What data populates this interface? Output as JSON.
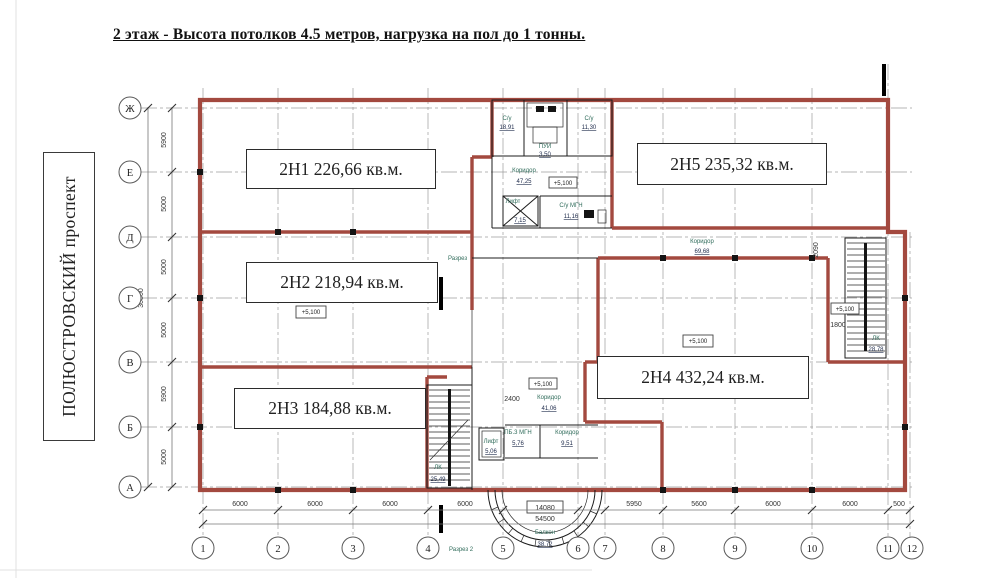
{
  "title": "2 этаж - Высота потолков 4.5 метров, нагрузка на пол до 1 тонны.",
  "street": "ПОЛЮСТРОВСКИЙ проспект",
  "units": {
    "u1": "2Н1 226,66 кв.м.",
    "u2": "2Н2 218,94 кв.м.",
    "u3": "2Н3 184,88 кв.м.",
    "u4": "2Н4 432,24 кв.м.",
    "u5": "2Н5 235,32 кв.м."
  },
  "axes": {
    "rows": [
      "Ж",
      "Е",
      "Д",
      "Г",
      "В",
      "Б",
      "А"
    ],
    "cols": [
      "1",
      "2",
      "3",
      "4",
      "5",
      "6",
      "7",
      "8",
      "9",
      "10",
      "11",
      "12"
    ],
    "row_dims": [
      "5900",
      "5000",
      "5000",
      "5000",
      "5900",
      "5000"
    ],
    "row_total": "30800",
    "col_dims": [
      "6000",
      "6000",
      "6000",
      "6000",
      "5950",
      "5600",
      "6000",
      "6000",
      "500"
    ],
    "col_total": "54500"
  },
  "rooms": {
    "su_left": {
      "name": "С/у",
      "area": "18,91"
    },
    "su_right": {
      "name": "С/у",
      "area": "11,30"
    },
    "pui": {
      "name": "ПУИ",
      "area": "3,50"
    },
    "corridor_top": {
      "name": "Коридор",
      "area": "47,25"
    },
    "lift_top": {
      "name": "Лифт",
      "area": "7,15"
    },
    "su_mgn": {
      "name": "С/у МГН",
      "area": "11,16"
    },
    "corridor_mid": {
      "name": "Коридор",
      "area": "69,68"
    },
    "lk_right": {
      "name": "ЛК",
      "area": "28,78"
    },
    "corridor_low": {
      "name": "Коридор",
      "area": "41,06"
    },
    "pb_mgn": {
      "name": "ПБ.3 МГН",
      "area": "5,76"
    },
    "corridor_small": {
      "name": "Коридор",
      "area": "9,51"
    },
    "lift_low": {
      "name": "Лифт",
      "area": "5,06"
    },
    "lk_low": {
      "name": "ЛК",
      "area": "25,49"
    },
    "balcony": {
      "name": "Балкон",
      "area": "38,72"
    }
  },
  "marks": {
    "elevation": "+5,100",
    "section1": "Разрез",
    "section2": "Разрез 2",
    "dim_1800": "1800",
    "dim_2090": "2090",
    "dim_2400": "2400",
    "dim_14080": "14080"
  },
  "colors": {
    "wall_red": "#a3493f",
    "room_name_teal": "#2f6b5a"
  }
}
